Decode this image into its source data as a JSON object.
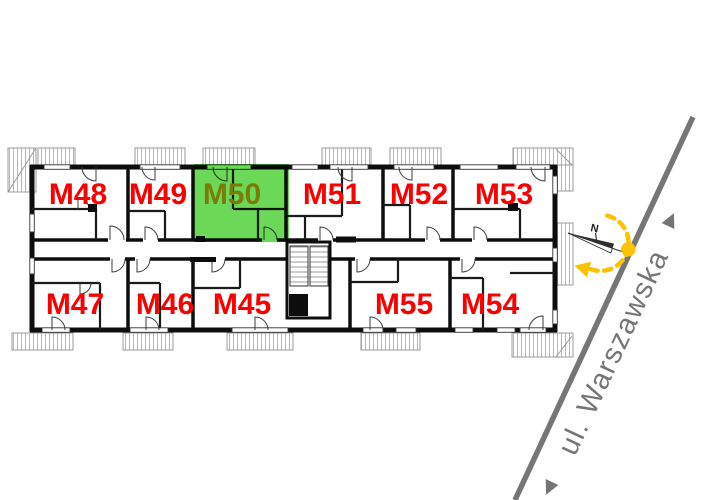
{
  "floor_plan": {
    "units": [
      {
        "id": "M48",
        "row": "top",
        "highlighted": false
      },
      {
        "id": "M49",
        "row": "top",
        "highlighted": false
      },
      {
        "id": "M50",
        "row": "top",
        "highlighted": true
      },
      {
        "id": "M51",
        "row": "top",
        "highlighted": false
      },
      {
        "id": "M52",
        "row": "top",
        "highlighted": false
      },
      {
        "id": "M53",
        "row": "top",
        "highlighted": false
      },
      {
        "id": "M47",
        "row": "bottom",
        "highlighted": false
      },
      {
        "id": "M46",
        "row": "bottom",
        "highlighted": false
      },
      {
        "id": "M45",
        "row": "bottom",
        "highlighted": false
      },
      {
        "id": "M55",
        "row": "bottom",
        "highlighted": false
      },
      {
        "id": "M54",
        "row": "bottom",
        "highlighted": false
      }
    ],
    "unit_label_color": "#fa0000",
    "highlighted_unit": "M50",
    "highlight_fill": "#46cf2e",
    "highlighted_unit_label_color": "#7a7c08"
  },
  "street": {
    "name": "ul. Warszawska",
    "color": "#757575"
  },
  "compass": {
    "north_label": "N"
  },
  "sun_indicator": {
    "color": "#fcc200"
  }
}
